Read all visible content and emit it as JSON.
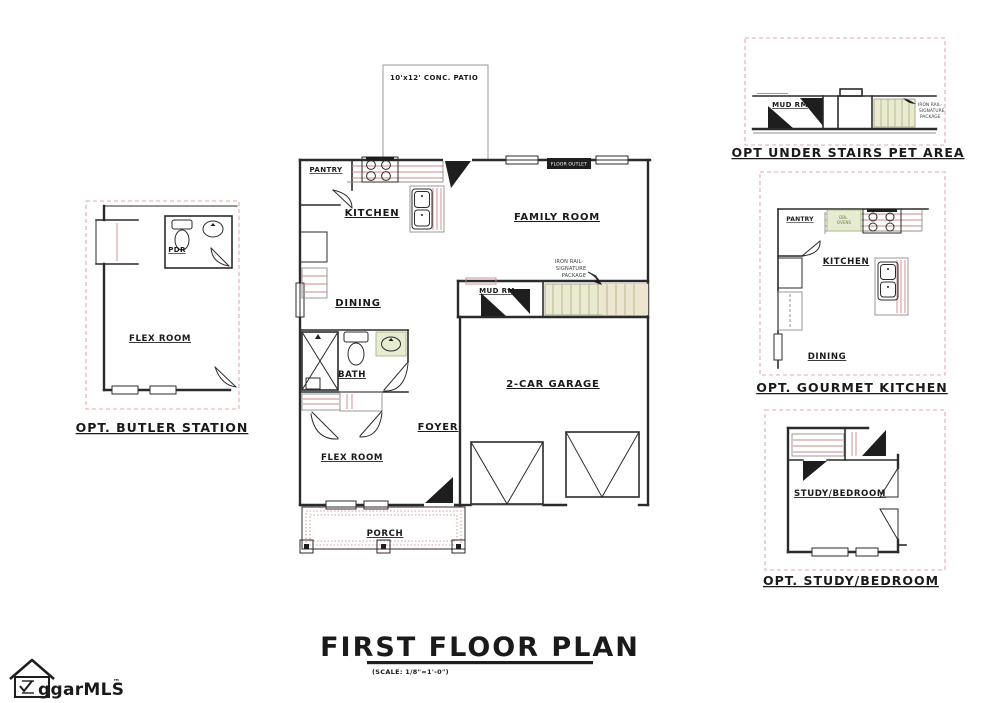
{
  "footer": {
    "title": "FIRST FLOOR PLAN",
    "scale_note": "(SCALE: 1/8\"=1'-0\")"
  },
  "logo": {
    "text": "ggarMLS",
    "trademark": "™"
  },
  "main_plan": {
    "patio_label": "10'x12' CONC. PATIO",
    "rooms": {
      "pantry": "PANTRY",
      "kitchen": "KITCHEN",
      "family_room": "FAMILY ROOM",
      "dining": "DINING",
      "mud_rm": "MUD RM",
      "bath": "BATH",
      "foyer": "FOYER",
      "garage": "2-CAR GARAGE",
      "flex_room": "FLEX ROOM",
      "porch": "PORCH"
    },
    "annotations": {
      "iron_rail_lines": [
        "IRON RAIL-",
        "SIGNATURE",
        "PACKAGE"
      ],
      "floor_outlet": "FLOOR OUTLET"
    }
  },
  "insets": {
    "butler_station": {
      "title": "OPT. BUTLER STATION",
      "rooms": {
        "pdr": "PDR",
        "flex_room": "FLEX ROOM"
      }
    },
    "pet_area": {
      "title": "OPT UNDER STAIRS PET AREA",
      "rooms": {
        "mud_rm": "MUD RM"
      },
      "iron_rail_lines": [
        "IRON RAIL-",
        "SIGNATURE",
        "PACKAGE"
      ]
    },
    "gourmet_kitchen": {
      "title": "OPT. GOURMET KITCHEN",
      "rooms": {
        "pantry": "PANTRY",
        "kitchen": "KITCHEN",
        "dining": "DINING"
      },
      "appliance_label_lines": [
        "DBL",
        "OVENS"
      ]
    },
    "study_bedroom": {
      "title": "OPT. STUDY/BEDROOM",
      "rooms": {
        "study_bedroom": "STUDY/BEDROOM"
      }
    }
  },
  "colors": {
    "wall": "#2b2b2b",
    "counter_line": "#cc8888",
    "inset_border": "#e5a8a8",
    "stair_fill": "#e9ead0",
    "stair_line": "#b3ba8e",
    "highlight_fill": "#e6ecd2",
    "highlight_line": "#a9b87e"
  }
}
